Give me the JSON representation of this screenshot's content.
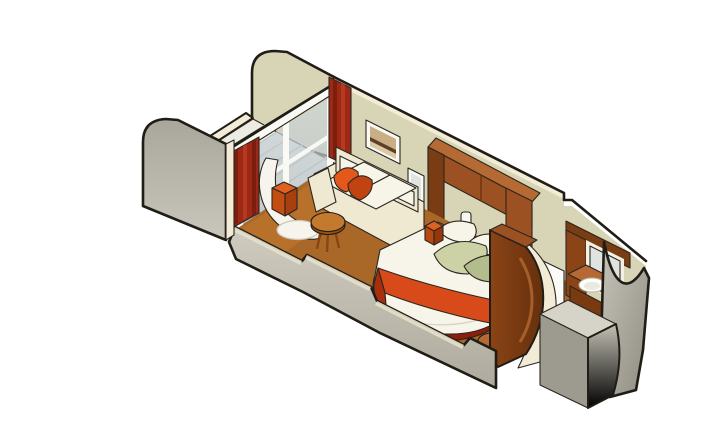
{
  "illustration": {
    "kind": "isometric-cutaway-cruise-stateroom",
    "background": "#ffffff"
  },
  "colors": {
    "outline": "#201c16",
    "wall_beige": "#d8d4b6",
    "wall_cream_edge": "#f2ecd6",
    "wall_gray_light": "#d6d3c8",
    "wall_gray_dark": "#9d9a8f",
    "deck_plank": "#ecebe4",
    "deck_gap": "#bcbbb2",
    "glass_frame_white": "#fafaf5",
    "curtain_red": "#9e2816",
    "curtain_dark": "#7c1e0e",
    "curtain_light": "#b53a20",
    "carpet": "#aa6828",
    "carpet_light": "#c47a2e",
    "carpet_dark": "#91541e",
    "tile": "#e9dfbc",
    "tile_line": "#cfc196",
    "doorway_white": "#fbfaf6",
    "sofa_cream": "#efe9d2",
    "cushion_white": "#f7f4e8",
    "pillow_orange": "#e4581c",
    "pillow_orange_dark": "#c24312",
    "wood": "#9c5122",
    "wood_light": "#b46a32",
    "wood_dark": "#7a3c12",
    "bed_white": "#f7f4ea",
    "runner_red": "#d94a1a",
    "runner_red_dark": "#a72f0e",
    "bed_base_red": "#8c1f0c",
    "pillow_green": "#ccd2a6",
    "pillow_green_dark": "#b3bc8c",
    "art_sky": "#c9ae86",
    "art_dark": "#5e4026",
    "art_fg": "#dcc9a4",
    "chair_white": "#f6f4ec",
    "ottoman_orange": "#e06020",
    "ottoman_side": "#c44d12",
    "ottoman_dark": "#a83f0e",
    "sconce_white": "#f8f6ee",
    "mirror_glass": "#dfe4e0",
    "sink_white": "#fdfdfa",
    "bath_wall_white": "#f3f1e6",
    "lamp_orange": "#e06020"
  },
  "parts": [
    "balcony-partition-left",
    "balcony-partition-right",
    "balcony-deck",
    "deck-edge",
    "sliding-glass-doors",
    "door-top-rail",
    "curtain-left",
    "curtain-right",
    "lounge-chair",
    "ottoman",
    "sofa",
    "sofa-throw-pillows",
    "side-table",
    "wall-art",
    "mirror-panel",
    "reading-lamp",
    "overhead-cabinets",
    "headboard-posts",
    "wall-sconce",
    "double-bed",
    "bed-runner",
    "bed-pillows-green",
    "bed-pillows-white",
    "bedside-table",
    "curved-partition",
    "entry-doorway",
    "entry-tile-floor",
    "bathroom-vanity",
    "bathroom-sink",
    "bathroom-mirror",
    "cutaway-front-wall",
    "cutaway-entry-wall",
    "cutaway-bathroom-wall",
    "carpet"
  ]
}
